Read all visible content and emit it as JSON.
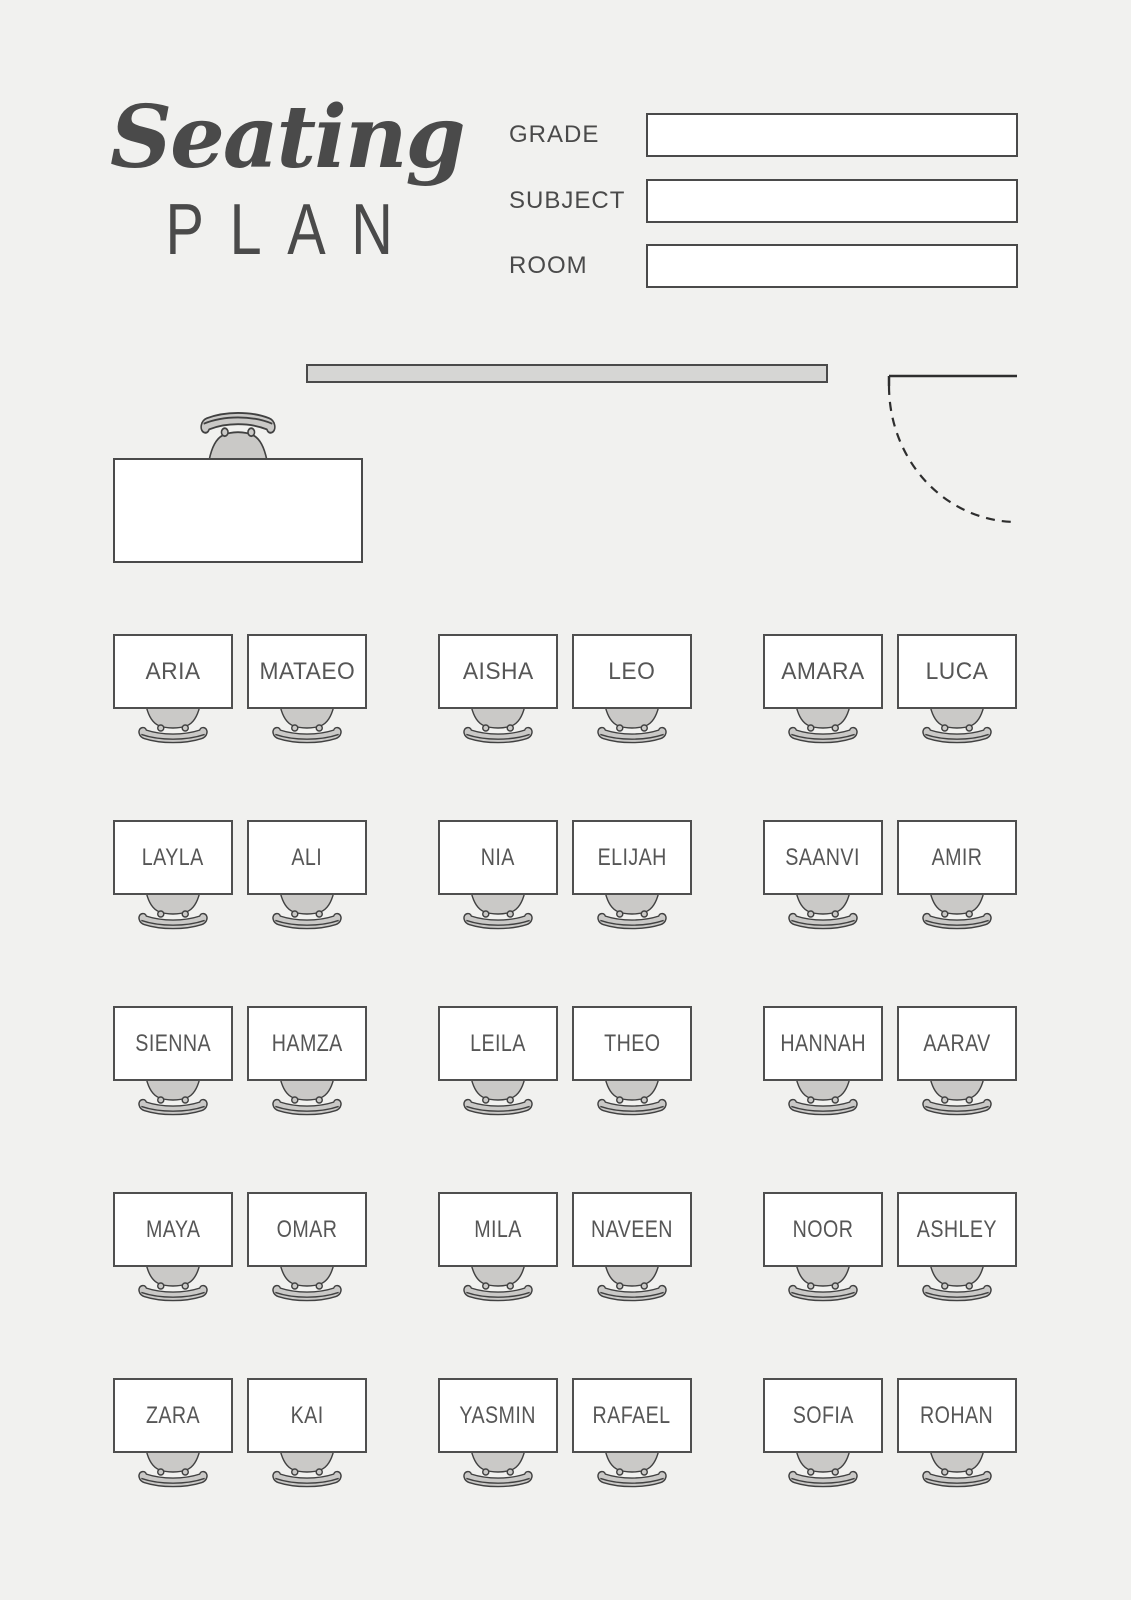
{
  "header": {
    "title_script": "Seating",
    "title_sub": "PLAN",
    "form": {
      "fields": [
        {
          "label": "GRADE",
          "value": ""
        },
        {
          "label": "SUBJECT",
          "value": ""
        },
        {
          "label": "ROOM",
          "value": ""
        }
      ]
    }
  },
  "classroom": {
    "fixtures": [
      "whiteboard",
      "door-swing",
      "teacher-desk",
      "teacher-chair"
    ]
  },
  "seating": {
    "rows": [
      {
        "groups": [
          [
            "ARIA",
            "MATAEO"
          ],
          [
            "AISHA",
            "LEO"
          ],
          [
            "AMARA",
            "LUCA"
          ]
        ]
      },
      {
        "groups": [
          [
            "LAYLA",
            "ALI"
          ],
          [
            "NIA",
            "ELIJAH"
          ],
          [
            "SAANVI",
            "AMIR"
          ]
        ]
      },
      {
        "groups": [
          [
            "SIENNA",
            "HAMZA"
          ],
          [
            "LEILA",
            "THEO"
          ],
          [
            "HANNAH",
            "AARAV"
          ]
        ]
      },
      {
        "groups": [
          [
            "MAYA",
            "OMAR"
          ],
          [
            "MILA",
            "NAVEEN"
          ],
          [
            "NOOR",
            "ASHLEY"
          ]
        ]
      },
      {
        "groups": [
          [
            "ZARA",
            "KAI"
          ],
          [
            "YASMIN",
            "RAFAEL"
          ],
          [
            "SOFIA",
            "ROHAN"
          ]
        ]
      }
    ]
  },
  "colors": {
    "background": "#f1f1ef",
    "ink": "#4a4a4a",
    "desk_border": "#4f4f4f",
    "desk_fill": "#ffffff",
    "chair_fill": "#cac9c7",
    "chair_stroke": "#414141",
    "whiteboard_fill": "#d6d6d4",
    "name_text": "#565656"
  }
}
